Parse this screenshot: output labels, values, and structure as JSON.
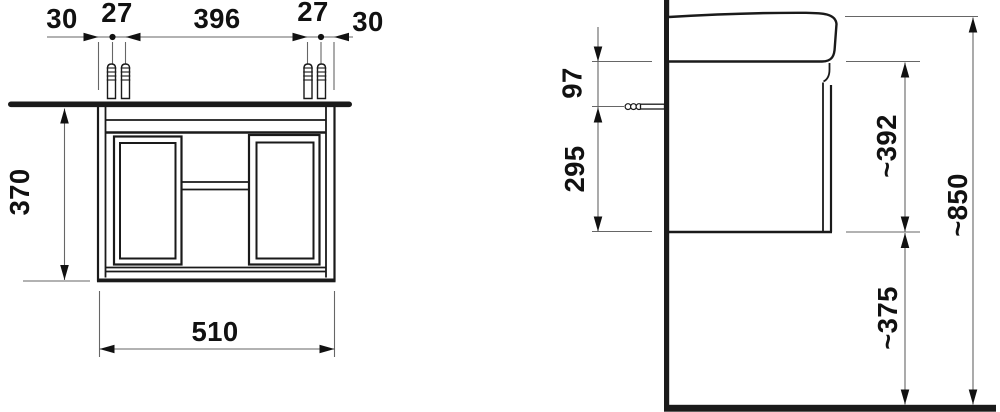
{
  "document": {
    "type": "technical-dimension-drawing",
    "subject": "wall-hung washbasin vanity unit, front and side elevation"
  },
  "front_view": {
    "label": "front view",
    "dims": {
      "edge_left": "30",
      "pair_left": "27",
      "span_center": "396",
      "pair_right": "27",
      "edge_right": "30",
      "height": "370",
      "width": "510"
    }
  },
  "side_view": {
    "label": "side view",
    "dims": {
      "rail_offset": "97",
      "rail_to_bottom": "295",
      "body_height": "~392",
      "clearance": "~375",
      "total_height": "~850"
    }
  },
  "style": {
    "outline_color": "#1a1a1a",
    "dim_line_color": "#666666",
    "text_color": "#111111",
    "background": "#ffffff"
  }
}
